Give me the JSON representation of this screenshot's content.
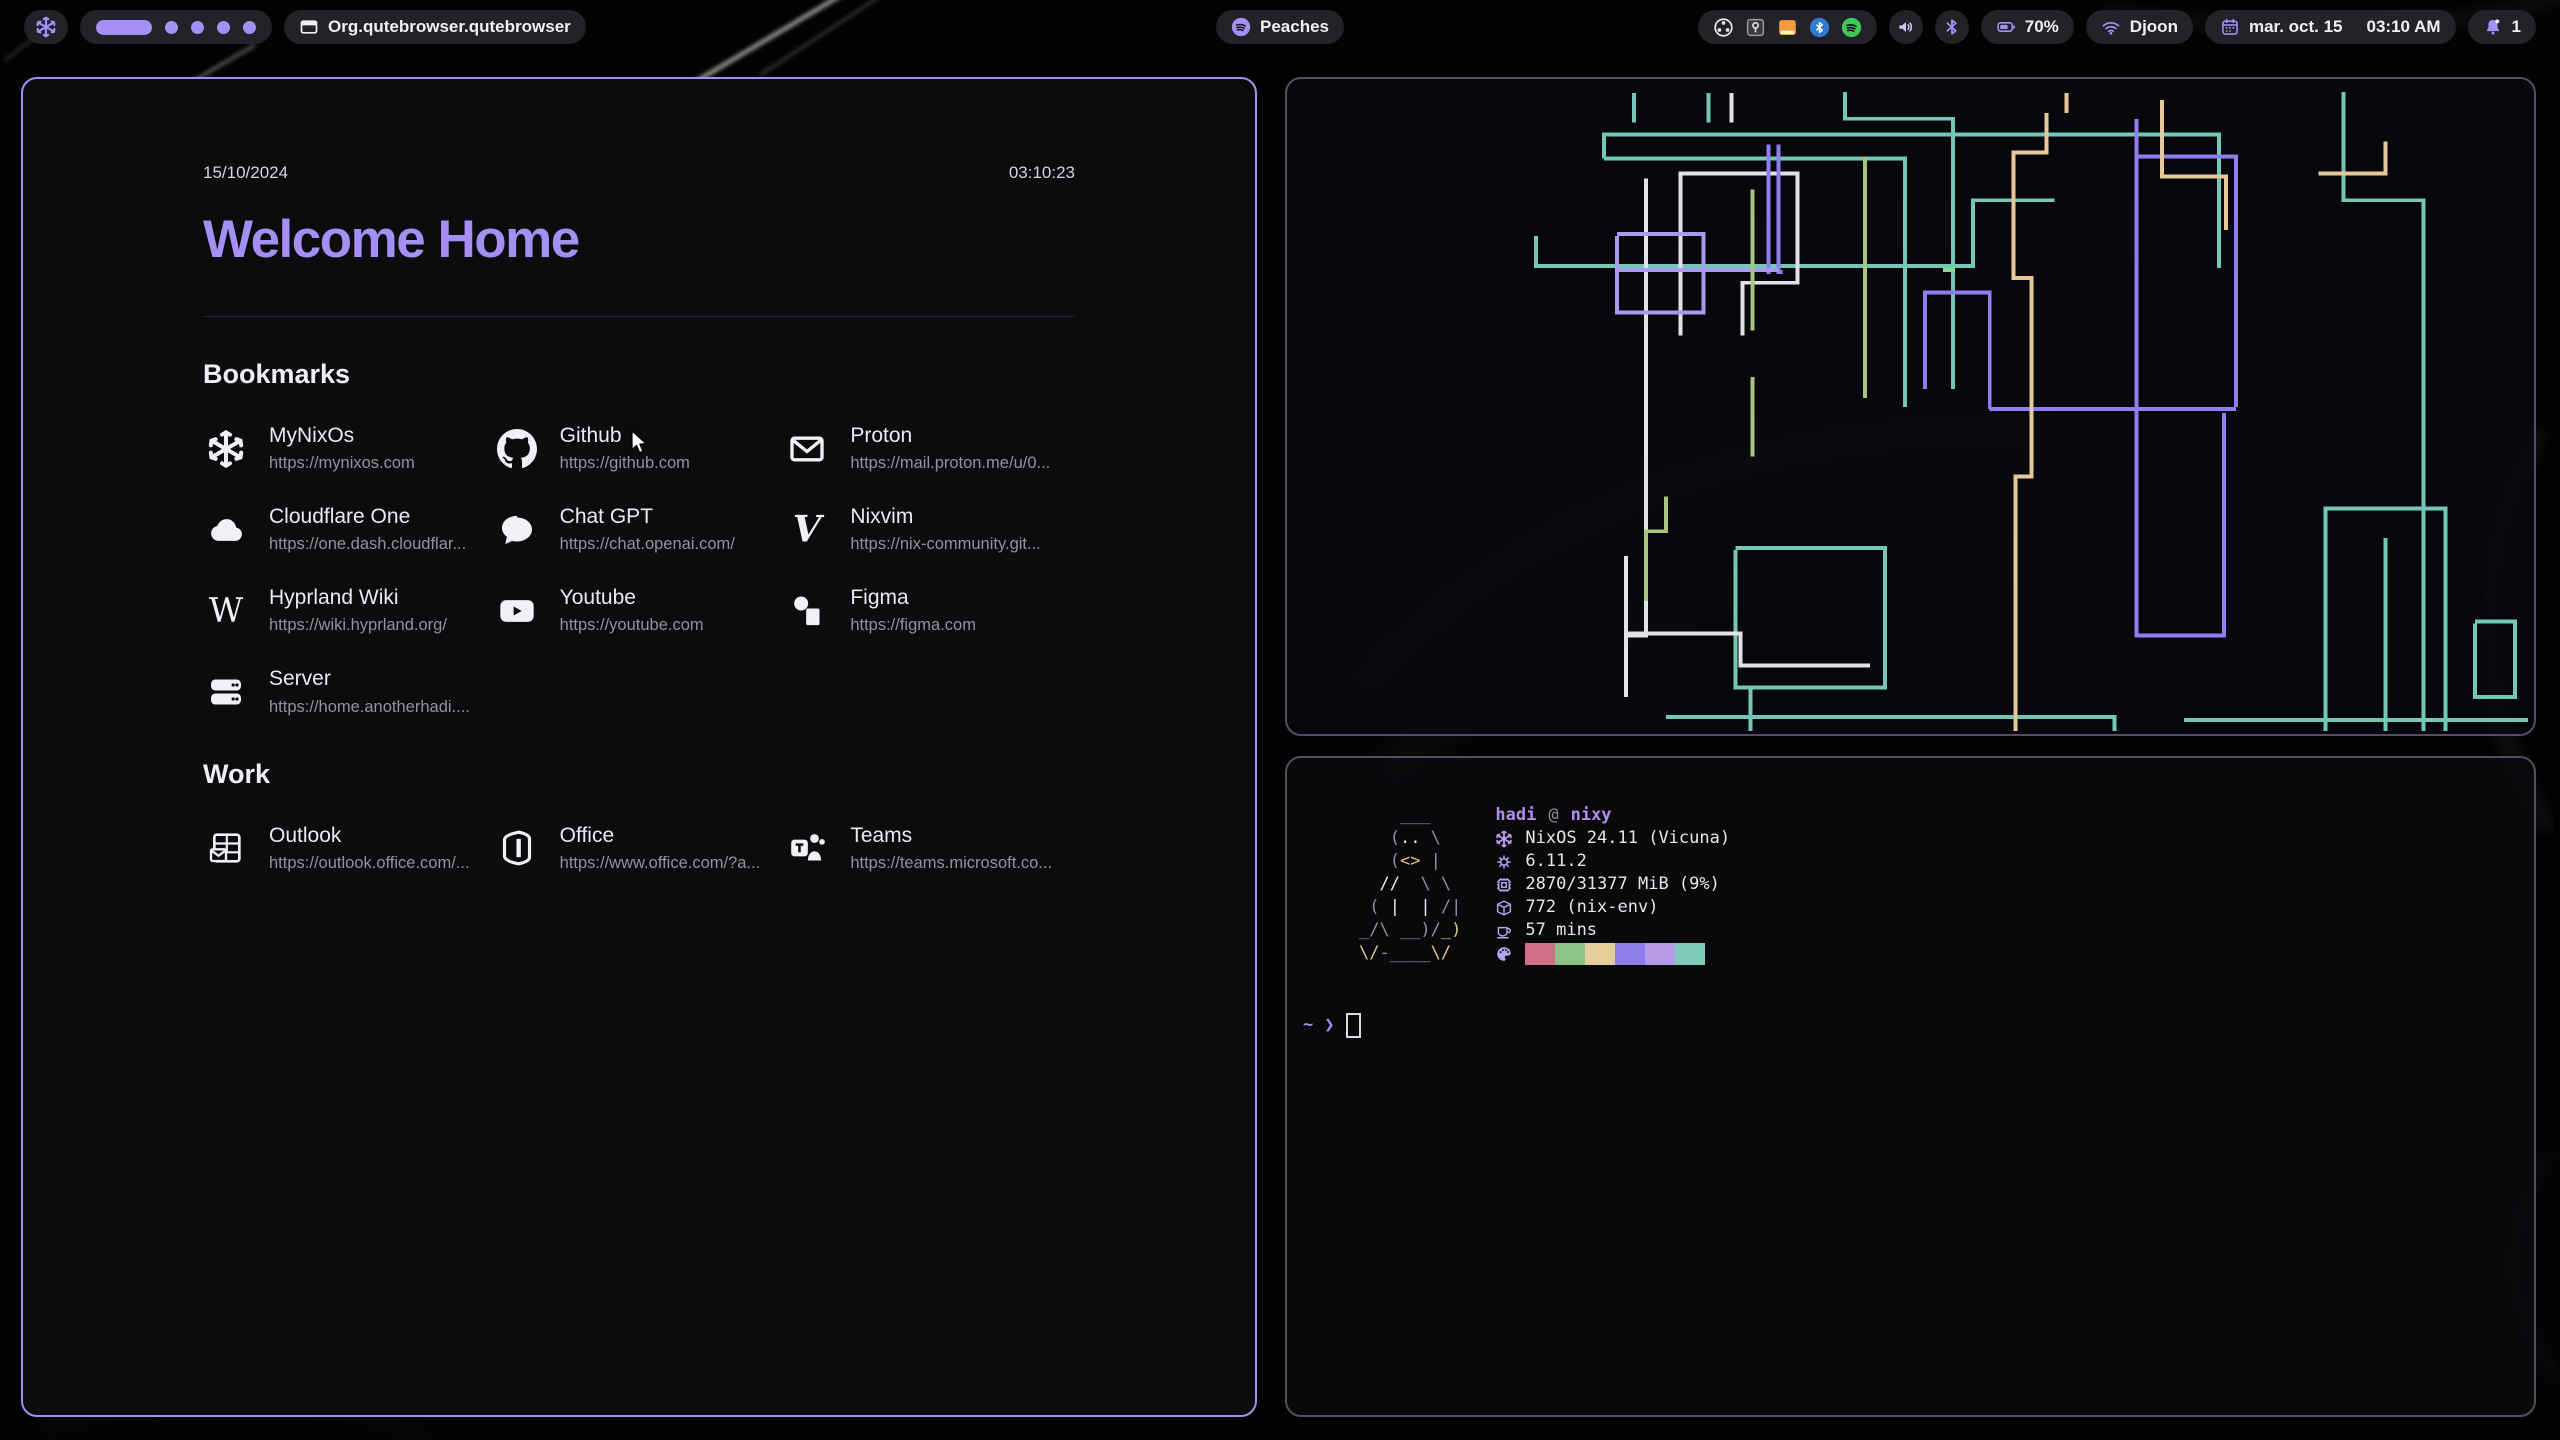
{
  "theme": {
    "accent": "#a48ff5",
    "window_border_active": "#a48ff2",
    "window_border_inactive": "#524e64",
    "pill_bg": "#242229",
    "spotify_green": "#3ec95f"
  },
  "topbar": {
    "launcher": {
      "icon": "nixos"
    },
    "workspaces": {
      "active": 1,
      "total": 5
    },
    "window_button": {
      "icon": "window",
      "label": "Org.qutebrowser.qutebrowser"
    },
    "media": {
      "icon": "spotify",
      "label": "Peaches"
    },
    "tray_icons": [
      "obs",
      "keepassxc",
      "files",
      "btbadge",
      "spotify"
    ],
    "battery": {
      "icon": "battery",
      "label": "70%"
    },
    "network": {
      "icon": "wifi",
      "label": "Djoon"
    },
    "clock": {
      "icon": "calendar",
      "date": "mar. oct. 15",
      "time": "03:10 AM"
    },
    "notifications": {
      "icon": "bell",
      "count": "1"
    }
  },
  "startpage": {
    "date": "15/10/2024",
    "time": "03:10:23",
    "title": "Welcome Home",
    "sections": [
      {
        "title": "Bookmarks",
        "links": [
          {
            "name": "MyNixOs",
            "url": "https://mynixos.com",
            "icon": "nixos"
          },
          {
            "name": "Github",
            "url": "https://github.com",
            "icon": "github"
          },
          {
            "name": "Proton",
            "url": "https://mail.proton.me/u/0...",
            "icon": "mail"
          },
          {
            "name": "Cloudflare One",
            "url": "https://one.dash.cloudflar...",
            "icon": "cloud"
          },
          {
            "name": "Chat GPT",
            "url": "https://chat.openai.com/",
            "icon": "chat"
          },
          {
            "name": "Nixvim",
            "url": "https://nix-community.git...",
            "icon": "vim"
          },
          {
            "name": "Hyprland Wiki",
            "url": "https://wiki.hyprland.org/",
            "icon": "wikipedia"
          },
          {
            "name": "Youtube",
            "url": "https://youtube.com",
            "icon": "youtube"
          },
          {
            "name": "Figma",
            "url": "https://figma.com",
            "icon": "figma"
          },
          {
            "name": "Server",
            "url": "https://home.anotherhadi....",
            "icon": "server"
          }
        ]
      },
      {
        "title": "Work",
        "links": [
          {
            "name": "Outlook",
            "url": "https://outlook.office.com/...",
            "icon": "outlook"
          },
          {
            "name": "Office",
            "url": "https://www.office.com/?a...",
            "icon": "office"
          },
          {
            "name": "Teams",
            "url": "https://teams.microsoft.co...",
            "icon": "teams"
          }
        ]
      }
    ]
  },
  "fetch": {
    "user": "hadi",
    "at": "@",
    "host": "nixy",
    "ascii": [
      [
        [
          "g",
          "    ___"
        ]
      ],
      [
        [
          "g",
          "   ("
        ],
        [
          "w",
          ".."
        ],
        [
          "g",
          " \\"
        ]
      ],
      [
        [
          "g",
          "   ("
        ],
        [
          "y",
          "<>"
        ],
        [
          "g",
          " |"
        ]
      ],
      [
        [
          "g",
          "  "
        ],
        [
          "w",
          "//"
        ],
        [
          "g",
          "  \\ \\"
        ]
      ],
      [
        [
          "g",
          " ( "
        ],
        [
          "w",
          "|  |"
        ],
        [
          "g",
          " /|"
        ]
      ],
      [
        [
          "g",
          "_/\\ __)/"
        ],
        [
          "y",
          "_)"
        ]
      ],
      [
        [
          "y",
          "\\/"
        ],
        [
          "g",
          "-____"
        ],
        [
          "y",
          "\\/"
        ]
      ]
    ],
    "info": [
      {
        "icon": "nixos",
        "text": "NixOS 24.11 (Vicuna)"
      },
      {
        "icon": "kernel",
        "text": "6.11.2"
      },
      {
        "icon": "memory",
        "text": "2870/31377 MiB (9%)"
      },
      {
        "icon": "packages",
        "text": "772 (nix-env)"
      },
      {
        "icon": "uptime",
        "text": "57 mins"
      }
    ],
    "palette_icon": "palette",
    "palette": [
      "#d16f88",
      "#8ac489",
      "#e6cd9e",
      "#8d7de9",
      "#b39ae3",
      "#7fcab8"
    ],
    "prompt": {
      "cwd": "~",
      "arrow": "❯"
    }
  },
  "pipes": {
    "stroke_width": 4,
    "lines": [
      {
        "color": "#74c7b7",
        "points": "348,14 348,44"
      },
      {
        "color": "#74c7b7",
        "points": "423,14 423,44"
      },
      {
        "color": "#74c7b7",
        "points": "318,80 318,56 935,56 935,190"
      },
      {
        "color": "#74c7b7",
        "points": "318,80 620,80 620,330"
      },
      {
        "color": "#74c7b7",
        "points": "250,158 250,188 688,188 688,122 770,122"
      },
      {
        "color": "#74c7b7",
        "points": "560,13 560,40 668,40 668,312"
      },
      {
        "color": "#74c7b7",
        "points": "1060,13 1060,122 1140,122 1140,656"
      },
      {
        "color": "#74c7b7",
        "points": "450,472 600,472 600,612 450,612 450,474"
      },
      {
        "color": "#74c7b7",
        "points": "465,612 465,656"
      },
      {
        "color": "#74c7b7",
        "points": "380,642 830,642 830,656"
      },
      {
        "color": "#74c7b7",
        "points": "1042,656 1042,432 1162,432 1162,656"
      },
      {
        "color": "#74c7b7",
        "points": "1102,462 1102,656"
      },
      {
        "color": "#74c7b7",
        "points": "1192,546 1232,546 1232,622 1192,622 1192,548"
      },
      {
        "color": "#74c7b7",
        "points": "900,645 1245,645"
      },
      {
        "color": "#e3e1e6",
        "points": "446,14 446,44"
      },
      {
        "color": "#e3e1e6",
        "points": "360,100 360,560 340,560 340,622"
      },
      {
        "color": "#e3e1e6",
        "points": "395,258 395,95 512,95 512,205 457,205 457,258"
      },
      {
        "color": "#e3e1e6",
        "points": "340,480 340,558 455,558 455,590 585,590"
      },
      {
        "color": "#8d7ff0",
        "points": "483,66 483,196"
      },
      {
        "color": "#8d7ff0",
        "points": "493,66 493,194 497,194"
      },
      {
        "color": "#8d7ff0",
        "points": "640,312 640,215 705,215 705,332"
      },
      {
        "color": "#8d7ff0",
        "points": "705,332 952,332"
      },
      {
        "color": "#8d7ff0",
        "points": "852,78 952,78 952,330"
      },
      {
        "color": "#8d7ff0",
        "points": "852,40 852,560 940,560 940,336"
      },
      {
        "color": "#a89bee",
        "points": "331,156 418,156 418,235 331,235 331,158"
      },
      {
        "color": "#a89bee",
        "points": "331,192 493,192"
      },
      {
        "color": "#a9c47f",
        "points": "467,111 467,253"
      },
      {
        "color": "#a9c47f",
        "points": "467,300 467,380"
      },
      {
        "color": "#a9c47f",
        "points": "580,78 580,321"
      },
      {
        "color": "#a9c47f",
        "points": "380,420 380,455 360,455 360,525"
      },
      {
        "color": "#94d494",
        "points": "658,192 670,192"
      },
      {
        "color": "#e6c89c",
        "points": "782,14 782,34"
      },
      {
        "color": "#e6c89c",
        "points": "762,34 762,74 729,74 729,200 747,200 747,400 731,400 731,656"
      },
      {
        "color": "#e6c89c",
        "points": "878,21 878,98 942,98 942,152"
      },
      {
        "color": "#e6c89c",
        "points": "1035,95 1102,95 1102,63"
      }
    ]
  }
}
